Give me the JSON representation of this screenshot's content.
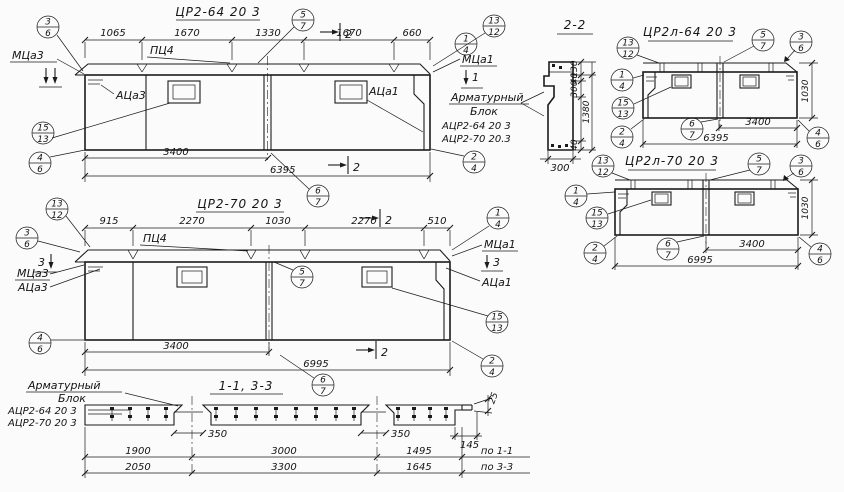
{
  "elev1": {
    "title": "ЦР2-64 20 3",
    "dims_top": [
      "1065",
      "1670",
      "1330",
      "1670",
      "660"
    ],
    "dim_3400": "3400",
    "dim_total": "6395",
    "cap_label": "ПЦ4",
    "mark_left": "МЦа3",
    "anchor_left": "АЦа3",
    "mark_right": "МЦа1",
    "anchor_right": "АЦа1",
    "sec_mid": "2",
    "sec_mid_bottom": "2",
    "sec_right": "1",
    "circles": [
      [
        "3",
        "6"
      ],
      [
        "5",
        "7"
      ],
      [
        "13",
        "12"
      ],
      [
        "1",
        "4"
      ],
      [
        "15",
        "13"
      ],
      [
        "4",
        "6"
      ],
      [
        "2",
        "4"
      ],
      [
        "6",
        "7"
      ]
    ]
  },
  "elev2": {
    "title": "ЦР2-70 20 3",
    "dims_top": [
      "915",
      "2270",
      "1030",
      "2270",
      "510"
    ],
    "dim_3400": "3400",
    "dim_total": "6995",
    "cap_label": "ПЦ4",
    "mark_left": "МЦа3",
    "anchor_left": "АЦа3",
    "mark_right": "МЦа1",
    "anchor_right": "АЦа1",
    "sec_left": "3",
    "sec_mid": "2",
    "sec_mid_bottom": "2",
    "sec_right": "3",
    "circles": [
      [
        "13",
        "12"
      ],
      [
        "3",
        "6"
      ],
      [
        "5",
        "7"
      ],
      [
        "1",
        "4"
      ],
      [
        "15",
        "13"
      ],
      [
        "2",
        "4"
      ],
      [
        "4",
        "6"
      ],
      [
        "6",
        "7"
      ]
    ]
  },
  "section22": {
    "title": "2-2",
    "d130": "130",
    "d40a": "40",
    "d300": "300",
    "d1380": "1380",
    "d40b": "40",
    "width": "300"
  },
  "panelA": {
    "title": "ЦР2л-64 20 3",
    "dim_3400": "3400",
    "dim_total": "6395",
    "dim_height": "1030",
    "circles": [
      [
        "13",
        "12"
      ],
      [
        "1",
        "4"
      ],
      [
        "15",
        "13"
      ],
      [
        "2",
        "4"
      ],
      [
        "5",
        "7"
      ],
      [
        "3",
        "6"
      ],
      [
        "6",
        "7"
      ],
      [
        "4",
        "6"
      ]
    ]
  },
  "panelB": {
    "title": "ЦР2л-70 20 3",
    "dim_3400": "3400",
    "dim_total": "6995",
    "dim_height": "1030",
    "circles": [
      [
        "13",
        "12"
      ],
      [
        "1",
        "4"
      ],
      [
        "15",
        "13"
      ],
      [
        "2",
        "4"
      ],
      [
        "5",
        "7"
      ],
      [
        "3",
        "6"
      ],
      [
        "6",
        "7"
      ],
      [
        "4",
        "6"
      ]
    ]
  },
  "arm_right": {
    "line1": "Арматурный",
    "line2": "Блок",
    "item1": "АЦР2-64 20 3",
    "item2": "АЦР2-70 20.3"
  },
  "arm_bottom": {
    "line1": "Арматурный",
    "line2": "Блок",
    "item1": "АЦР2-64 20 3",
    "item2": "АЦР2-70 20 3"
  },
  "strip": {
    "title": "1-1, 3-3",
    "gap1": "350",
    "gap2": "350",
    "end": "145",
    "thk": "25",
    "row1": [
      "1900",
      "3000",
      "1495"
    ],
    "row1_label": "по 1-1",
    "row2": [
      "2050",
      "3300",
      "1645"
    ],
    "row2_label": "по 3-3"
  }
}
